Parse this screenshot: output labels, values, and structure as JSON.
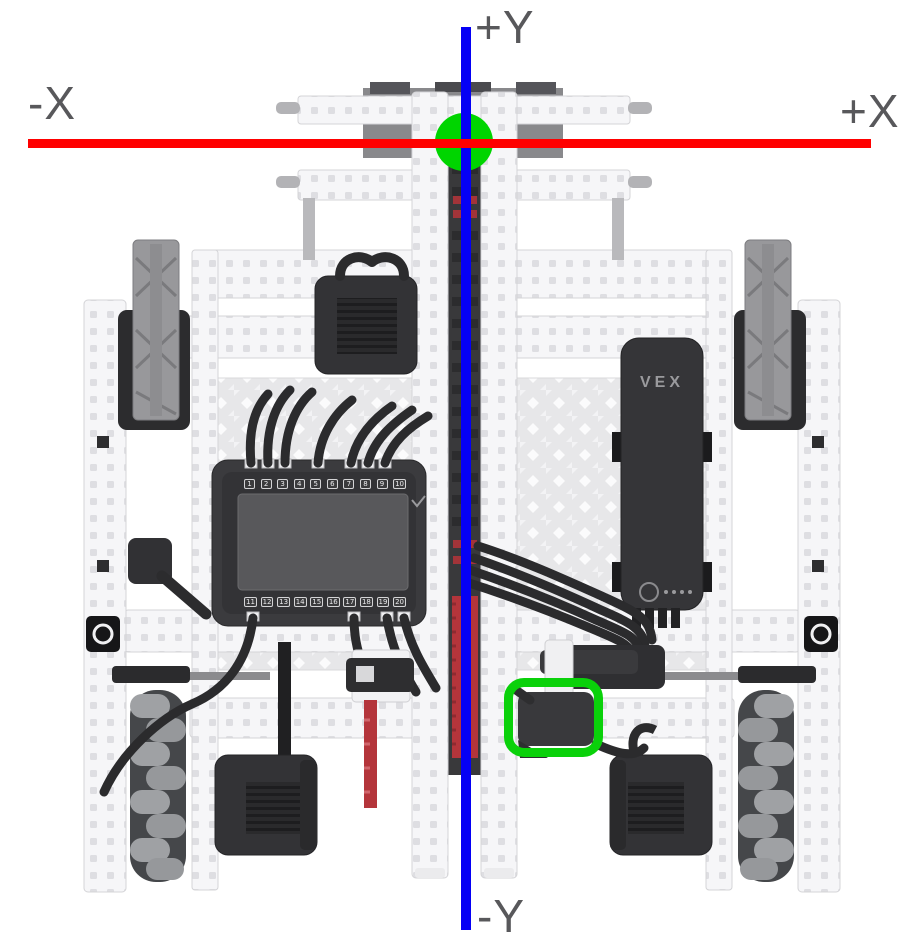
{
  "diagram": {
    "axis": {
      "pos_y": "+Y",
      "neg_y": "-Y",
      "pos_x": "+X",
      "neg_x": "-X",
      "x_axis_color": "#ff0000",
      "y_axis_color": "#0500f5",
      "origin_color": "#00d500",
      "highlight_color": "#0ad10a",
      "label_color": "#58585b"
    },
    "robot": {
      "brain": {
        "ports_top": [
          "1",
          "2",
          "3",
          "4",
          "5",
          "6",
          "7",
          "8",
          "9",
          "10"
        ],
        "ports_bottom": [
          "11",
          "12",
          "13",
          "14",
          "15",
          "16",
          "17",
          "18",
          "19",
          "20"
        ]
      },
      "battery": {
        "logo": "VEX"
      }
    }
  }
}
